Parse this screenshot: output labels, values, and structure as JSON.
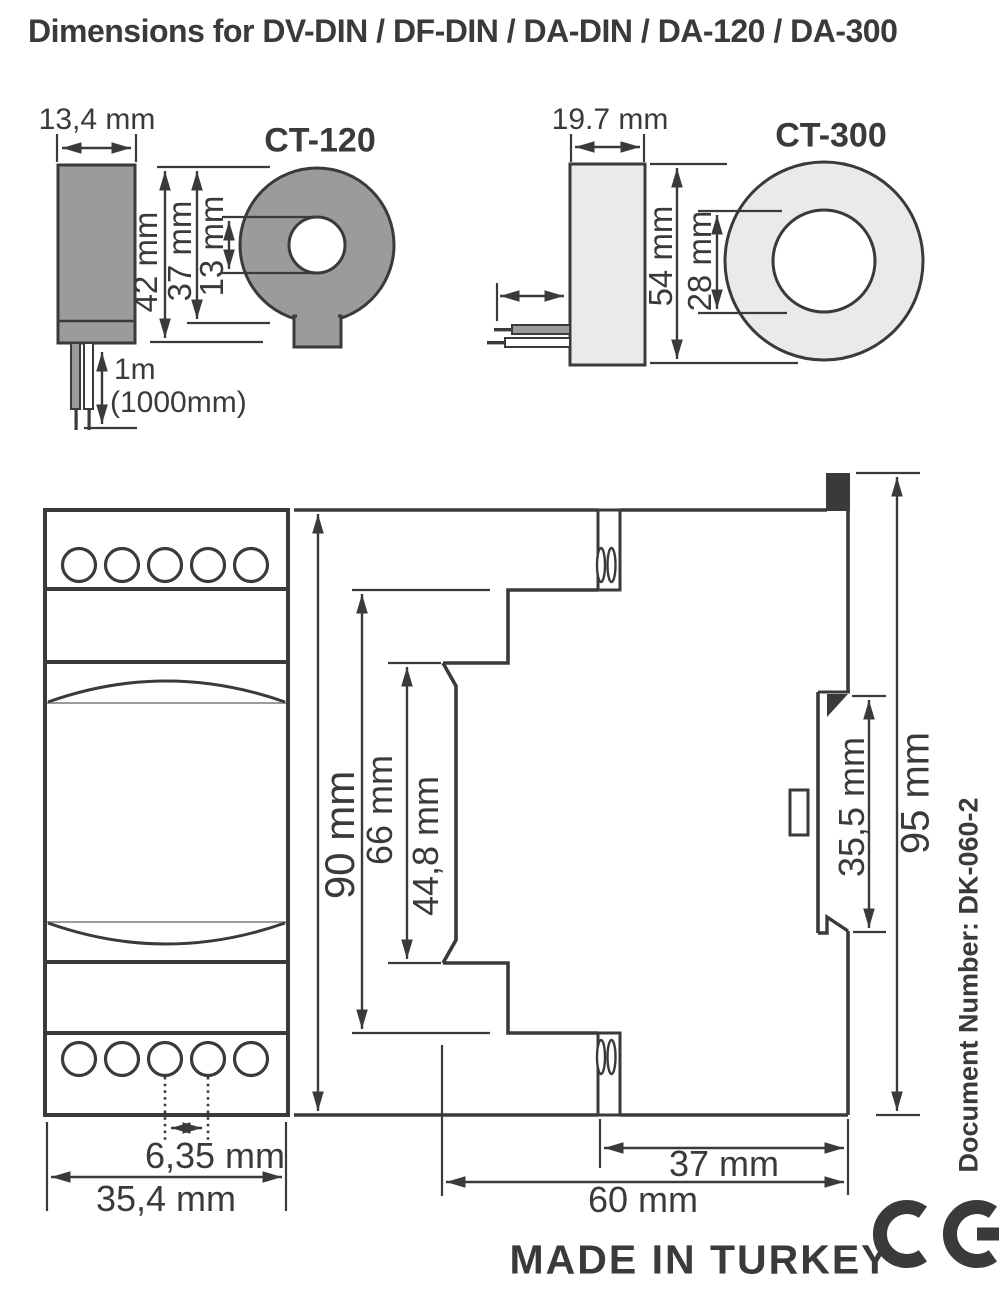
{
  "title": "Dimensions for DV-DIN / DF-DIN / DA-DIN / DA-120 / DA-300",
  "ct120": {
    "label": "CT-120",
    "body_width": "13,4 mm",
    "overall_height": "42 mm",
    "body_height": "37 mm",
    "hole_diameter": "13 mm",
    "cable_length": "1m",
    "cable_length_alt": "(1000mm)"
  },
  "ct300": {
    "label": "CT-300",
    "body_width": "19.7 mm",
    "outer_diameter": "54 mm",
    "hole_diameter": "28 mm"
  },
  "din_module": {
    "front_height": "90 mm",
    "mid_height": "66 mm",
    "display_height": "44,8 mm",
    "terminal_pitch": "6,35 mm",
    "front_width": "35,4 mm",
    "rear_depth": "37 mm",
    "overall_depth": "60 mm",
    "din_slot_height": "35,5 mm",
    "overall_height": "95 mm"
  },
  "footer": {
    "made_in": "MADE IN TURKEY",
    "ce_mark": "CE"
  },
  "document_number": "Document Number: DK-060-2",
  "colors": {
    "line": "#3a3a3a",
    "gray": "#9b9b9b",
    "light_gray": "#eaeaea",
    "background": "#ffffff"
  }
}
